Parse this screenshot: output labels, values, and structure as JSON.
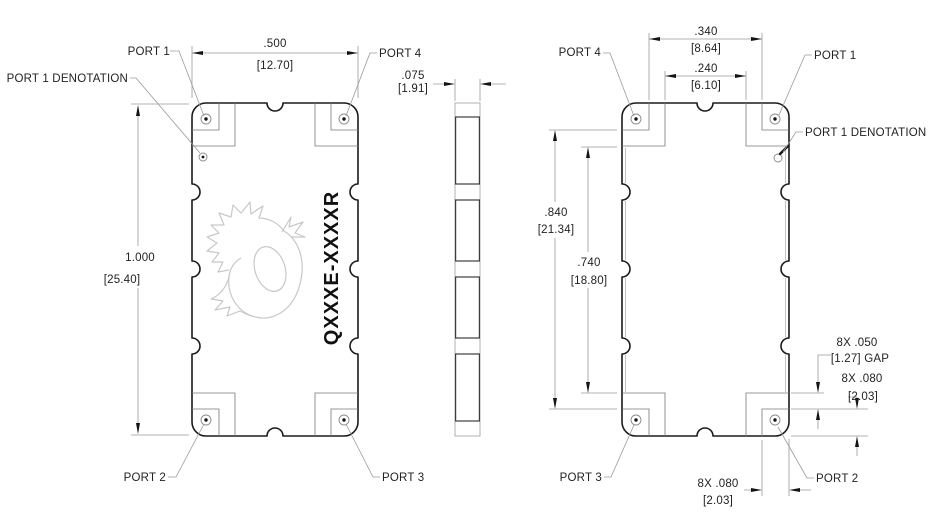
{
  "drawing": {
    "part_number": "QXXXE-XXXXR",
    "labels": {
      "port1": "PORT 1",
      "port2": "PORT 2",
      "port3": "PORT 3",
      "port4": "PORT 4",
      "port1_denotation": "PORT 1 DENOTATION"
    },
    "colors": {
      "outline": "#1a1a1a",
      "thin_line": "#9a9a9a",
      "text": "#222222",
      "logo": "#c8c8c8",
      "background": "#ffffff"
    },
    "top_view": {
      "width_in": ".500",
      "width_mm": "[12.70]",
      "height_in": "1.000",
      "height_mm": "[25.40]"
    },
    "side_view": {
      "thickness_in": ".075",
      "thickness_mm": "[1.91]"
    },
    "bottom_view": {
      "pad_span_outer_in": ".340",
      "pad_span_outer_mm": "[8.64]",
      "pad_span_inner_in": ".240",
      "pad_span_inner_mm": "[6.10]",
      "pad_height_outer_in": ".840",
      "pad_height_outer_mm": "[21.34]",
      "pad_height_inner_in": ".740",
      "pad_height_inner_mm": "[18.80]",
      "gap_count_in": "8X .050",
      "gap_mm_label": "[1.27] GAP",
      "pad_h_count_in": "8X .080",
      "pad_h_mm": "[2.03]",
      "pad_w_count_in": "8X .080",
      "pad_w_mm": "[2.03]"
    }
  }
}
